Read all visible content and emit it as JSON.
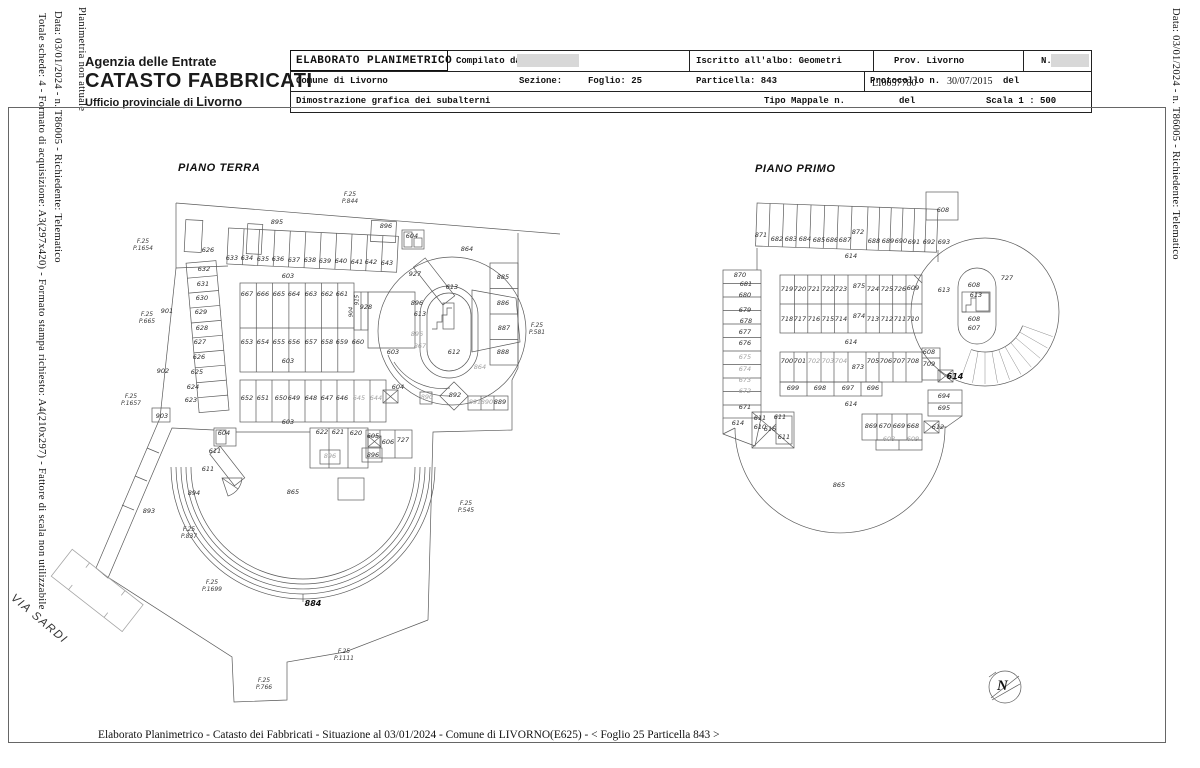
{
  "margins": {
    "left_note_1": "Planimetria non attuale",
    "left_note_2": "Data: 03/01/2024 - n. T86005 - Richiedente: Telematico",
    "left_note_3": "Totale schede: 4 - Formato di acquisizione: A3(297x420) - Formato stampa richiesto: A4(210x297) - Fattore di scala non utilizzabile",
    "right_note": "Data: 03/01/2024 - n. T86005 - Richiedente: Telematico"
  },
  "agency": {
    "line1": "Agenzia delle Entrate",
    "line2": "CATASTO FABBRICATI",
    "line3": "Ufficio provinciale di",
    "city": "Livorno"
  },
  "header_table": {
    "title": "ELABORATO PLANIMETRICO",
    "compilato_label": "Compilato da:",
    "iscritto": "Iscritto all'albo: Geometri",
    "prov": "Prov. Livorno",
    "n_label": "N.",
    "comune": "Comune di Livorno",
    "sezione": "Sezione:",
    "foglio": "Foglio: 25",
    "particella": "Particella: 843",
    "protocollo_label": "Protocollo n.",
    "protocollo_value": "LI0057780",
    "data_presentazione": "30/07/2015",
    "del1": "del",
    "dimostrazione": "Dimostrazione grafica dei subalterni",
    "tipo_mappale": "Tipo Mappale n.",
    "del2": "del",
    "scala": "Scala 1 : 500"
  },
  "street": "VIA SARDI",
  "compass_letter": "N",
  "footer": "Elaborato Planimetrico - Catasto dei Fabbricati - Situazione al 03/01/2024 - Comune di LIVORNO(E625) - < Foglio 25 Particella 843 >",
  "colors": {
    "redacted": "#d8d8d8",
    "linework": "#5a5a5a"
  },
  "plans": {
    "terra": {
      "title": "PIANO TERRA",
      "labels": [
        {
          "t": "895",
          "x": 277,
          "y": 223
        },
        {
          "t": "896",
          "x": 386,
          "y": 227
        },
        {
          "t": "604",
          "x": 412,
          "y": 237
        },
        {
          "t": "864",
          "x": 467,
          "y": 250
        },
        {
          "t": "626",
          "x": 208,
          "y": 251
        },
        {
          "t": "633",
          "x": 232,
          "y": 259
        },
        {
          "t": "634",
          "x": 247,
          "y": 259
        },
        {
          "t": "635",
          "x": 263,
          "y": 260
        },
        {
          "t": "636",
          "x": 278,
          "y": 260
        },
        {
          "t": "637",
          "x": 294,
          "y": 261
        },
        {
          "t": "638",
          "x": 310,
          "y": 261
        },
        {
          "t": "639",
          "x": 325,
          "y": 262
        },
        {
          "t": "640",
          "x": 341,
          "y": 262
        },
        {
          "t": "641",
          "x": 357,
          "y": 263
        },
        {
          "t": "642",
          "x": 371,
          "y": 263
        },
        {
          "t": "643",
          "x": 387,
          "y": 264
        },
        {
          "t": "632",
          "x": 204,
          "y": 270
        },
        {
          "t": "631",
          "x": 203,
          "y": 285
        },
        {
          "t": "630",
          "x": 202,
          "y": 299
        },
        {
          "t": "629",
          "x": 201,
          "y": 313
        },
        {
          "t": "628",
          "x": 202,
          "y": 329
        },
        {
          "t": "627",
          "x": 200,
          "y": 343
        },
        {
          "t": "626",
          "x": 199,
          "y": 358
        },
        {
          "t": "625",
          "x": 197,
          "y": 373
        },
        {
          "t": "624",
          "x": 193,
          "y": 388
        },
        {
          "t": "623",
          "x": 191,
          "y": 401
        },
        {
          "t": "901",
          "x": 167,
          "y": 312
        },
        {
          "t": "902",
          "x": 163,
          "y": 372
        },
        {
          "t": "903",
          "x": 162,
          "y": 417
        },
        {
          "t": "603",
          "x": 288,
          "y": 277
        },
        {
          "t": "603",
          "x": 288,
          "y": 362
        },
        {
          "t": "603",
          "x": 288,
          "y": 423
        },
        {
          "t": "667",
          "x": 247,
          "y": 295
        },
        {
          "t": "666",
          "x": 263,
          "y": 295
        },
        {
          "t": "665",
          "x": 279,
          "y": 295
        },
        {
          "t": "664",
          "x": 294,
          "y": 295
        },
        {
          "t": "663",
          "x": 311,
          "y": 295
        },
        {
          "t": "662",
          "x": 327,
          "y": 295
        },
        {
          "t": "661",
          "x": 342,
          "y": 295
        },
        {
          "t": "915",
          "x": 358,
          "y": 300,
          "s": "r"
        },
        {
          "t": "904",
          "x": 352,
          "y": 312,
          "s": "r"
        },
        {
          "t": "928",
          "x": 366,
          "y": 308
        },
        {
          "t": "653",
          "x": 247,
          "y": 343
        },
        {
          "t": "654",
          "x": 263,
          "y": 343
        },
        {
          "t": "655",
          "x": 279,
          "y": 343
        },
        {
          "t": "656",
          "x": 294,
          "y": 343
        },
        {
          "t": "657",
          "x": 311,
          "y": 343
        },
        {
          "t": "658",
          "x": 327,
          "y": 343
        },
        {
          "t": "659",
          "x": 342,
          "y": 343
        },
        {
          "t": "660",
          "x": 358,
          "y": 343
        },
        {
          "t": "652",
          "x": 247,
          "y": 399
        },
        {
          "t": "651",
          "x": 263,
          "y": 399
        },
        {
          "t": "650",
          "x": 281,
          "y": 399
        },
        {
          "t": "649",
          "x": 294,
          "y": 399
        },
        {
          "t": "648",
          "x": 311,
          "y": 399
        },
        {
          "t": "647",
          "x": 327,
          "y": 399
        },
        {
          "t": "646",
          "x": 342,
          "y": 399
        },
        {
          "t": "645",
          "x": 359,
          "y": 399,
          "s": "g"
        },
        {
          "t": "644",
          "x": 376,
          "y": 399,
          "s": "g"
        },
        {
          "t": "604",
          "x": 398,
          "y": 388
        },
        {
          "t": "890",
          "x": 427,
          "y": 398,
          "s": "g"
        },
        {
          "t": "892",
          "x": 455,
          "y": 396
        },
        {
          "t": "891",
          "x": 475,
          "y": 403,
          "s": "g"
        },
        {
          "t": "890",
          "x": 487,
          "y": 403,
          "s": "g"
        },
        {
          "t": "889",
          "x": 500,
          "y": 403
        },
        {
          "t": "622",
          "x": 322,
          "y": 433
        },
        {
          "t": "621",
          "x": 338,
          "y": 433
        },
        {
          "t": "620",
          "x": 356,
          "y": 434
        },
        {
          "t": "605",
          "x": 373,
          "y": 437
        },
        {
          "t": "606",
          "x": 388,
          "y": 443
        },
        {
          "t": "727",
          "x": 403,
          "y": 441
        },
        {
          "t": "896",
          "x": 330,
          "y": 457,
          "s": "g"
        },
        {
          "t": "896",
          "x": 373,
          "y": 456
        },
        {
          "t": "604",
          "x": 224,
          "y": 434
        },
        {
          "t": "611",
          "x": 215,
          "y": 452
        },
        {
          "t": "611",
          "x": 208,
          "y": 470
        },
        {
          "t": "894",
          "x": 194,
          "y": 494
        },
        {
          "t": "893",
          "x": 149,
          "y": 512
        },
        {
          "t": "927",
          "x": 415,
          "y": 275
        },
        {
          "t": "613",
          "x": 452,
          "y": 288
        },
        {
          "t": "896",
          "x": 417,
          "y": 304
        },
        {
          "t": "613",
          "x": 420,
          "y": 315
        },
        {
          "t": "896",
          "x": 417,
          "y": 335,
          "s": "g"
        },
        {
          "t": "867",
          "x": 420,
          "y": 347,
          "s": "g"
        },
        {
          "t": "603",
          "x": 393,
          "y": 353
        },
        {
          "t": "612",
          "x": 454,
          "y": 353
        },
        {
          "t": "864",
          "x": 480,
          "y": 368,
          "s": "g"
        },
        {
          "t": "885",
          "x": 503,
          "y": 278
        },
        {
          "t": "886",
          "x": 503,
          "y": 304
        },
        {
          "t": "887",
          "x": 504,
          "y": 329
        },
        {
          "t": "888",
          "x": 503,
          "y": 353
        },
        {
          "t": "865",
          "x": 293,
          "y": 493
        },
        {
          "t": "884",
          "x": 313,
          "y": 604,
          "s": "b"
        },
        {
          "t": "F.25\nP.1654",
          "x": 143,
          "y": 245,
          "s": "p"
        },
        {
          "t": "F.25\nP.844",
          "x": 350,
          "y": 198,
          "s": "p"
        },
        {
          "t": "F.25\nP.665",
          "x": 147,
          "y": 318,
          "s": "p"
        },
        {
          "t": "F.25\nP.1657",
          "x": 131,
          "y": 400,
          "s": "p"
        },
        {
          "t": "F.25\nP.581",
          "x": 537,
          "y": 329,
          "s": "p"
        },
        {
          "t": "F.25\nP.545",
          "x": 466,
          "y": 507,
          "s": "p"
        },
        {
          "t": "F.25\nP.837",
          "x": 189,
          "y": 533,
          "s": "p"
        },
        {
          "t": "F.25\nP.1699",
          "x": 212,
          "y": 586,
          "s": "p"
        },
        {
          "t": "F.25\nP.766",
          "x": 264,
          "y": 684,
          "s": "p"
        },
        {
          "t": "F.25\nP.1111",
          "x": 344,
          "y": 655,
          "s": "p"
        }
      ]
    },
    "primo": {
      "title": "PIANO PRIMO",
      "labels": [
        {
          "t": "871",
          "x": 761,
          "y": 236
        },
        {
          "t": "682",
          "x": 777,
          "y": 240
        },
        {
          "t": "683",
          "x": 791,
          "y": 240
        },
        {
          "t": "684",
          "x": 805,
          "y": 240
        },
        {
          "t": "685",
          "x": 819,
          "y": 241
        },
        {
          "t": "686",
          "x": 832,
          "y": 241
        },
        {
          "t": "687",
          "x": 845,
          "y": 241
        },
        {
          "t": "872",
          "x": 858,
          "y": 233
        },
        {
          "t": "688",
          "x": 874,
          "y": 242
        },
        {
          "t": "689",
          "x": 888,
          "y": 242
        },
        {
          "t": "690",
          "x": 901,
          "y": 242
        },
        {
          "t": "691",
          "x": 914,
          "y": 243
        },
        {
          "t": "692",
          "x": 929,
          "y": 243
        },
        {
          "t": "693",
          "x": 944,
          "y": 243
        },
        {
          "t": "608",
          "x": 943,
          "y": 211
        },
        {
          "t": "614",
          "x": 851,
          "y": 257
        },
        {
          "t": "870",
          "x": 740,
          "y": 276
        },
        {
          "t": "681",
          "x": 746,
          "y": 285
        },
        {
          "t": "680",
          "x": 745,
          "y": 296
        },
        {
          "t": "679",
          "x": 745,
          "y": 311
        },
        {
          "t": "678",
          "x": 746,
          "y": 322
        },
        {
          "t": "677",
          "x": 745,
          "y": 333
        },
        {
          "t": "676",
          "x": 745,
          "y": 344
        },
        {
          "t": "675",
          "x": 745,
          "y": 358,
          "s": "g"
        },
        {
          "t": "674",
          "x": 745,
          "y": 370,
          "s": "g"
        },
        {
          "t": "673",
          "x": 745,
          "y": 381,
          "s": "g"
        },
        {
          "t": "672",
          "x": 745,
          "y": 392,
          "s": "g"
        },
        {
          "t": "671",
          "x": 745,
          "y": 408
        },
        {
          "t": "719",
          "x": 787,
          "y": 290
        },
        {
          "t": "720",
          "x": 800,
          "y": 290
        },
        {
          "t": "721",
          "x": 814,
          "y": 290
        },
        {
          "t": "722",
          "x": 828,
          "y": 290
        },
        {
          "t": "723",
          "x": 841,
          "y": 290
        },
        {
          "t": "875",
          "x": 859,
          "y": 287
        },
        {
          "t": "724",
          "x": 873,
          "y": 290
        },
        {
          "t": "725",
          "x": 887,
          "y": 290
        },
        {
          "t": "726",
          "x": 900,
          "y": 290
        },
        {
          "t": "609",
          "x": 913,
          "y": 289
        },
        {
          "t": "718",
          "x": 787,
          "y": 320
        },
        {
          "t": "717",
          "x": 800,
          "y": 320
        },
        {
          "t": "716",
          "x": 814,
          "y": 320
        },
        {
          "t": "715",
          "x": 828,
          "y": 320
        },
        {
          "t": "714",
          "x": 841,
          "y": 320
        },
        {
          "t": "874",
          "x": 859,
          "y": 317
        },
        {
          "t": "713",
          "x": 873,
          "y": 320
        },
        {
          "t": "712",
          "x": 887,
          "y": 320
        },
        {
          "t": "711",
          "x": 900,
          "y": 320
        },
        {
          "t": "710",
          "x": 913,
          "y": 320
        },
        {
          "t": "614",
          "x": 851,
          "y": 343
        },
        {
          "t": "700",
          "x": 787,
          "y": 362
        },
        {
          "t": "701",
          "x": 800,
          "y": 362
        },
        {
          "t": "702",
          "x": 814,
          "y": 362,
          "s": "g"
        },
        {
          "t": "703",
          "x": 828,
          "y": 362,
          "s": "g"
        },
        {
          "t": "704",
          "x": 841,
          "y": 362,
          "s": "g"
        },
        {
          "t": "873",
          "x": 858,
          "y": 368
        },
        {
          "t": "705",
          "x": 873,
          "y": 362
        },
        {
          "t": "706",
          "x": 886,
          "y": 362
        },
        {
          "t": "707",
          "x": 899,
          "y": 362
        },
        {
          "t": "708",
          "x": 913,
          "y": 362
        },
        {
          "t": "699",
          "x": 793,
          "y": 389
        },
        {
          "t": "698",
          "x": 820,
          "y": 389
        },
        {
          "t": "697",
          "x": 848,
          "y": 389
        },
        {
          "t": "696",
          "x": 873,
          "y": 389
        },
        {
          "t": "608",
          "x": 929,
          "y": 353
        },
        {
          "t": "709",
          "x": 929,
          "y": 365
        },
        {
          "t": "614",
          "x": 955,
          "y": 377,
          "s": "b"
        },
        {
          "t": "694",
          "x": 944,
          "y": 397
        },
        {
          "t": "695",
          "x": 944,
          "y": 409
        },
        {
          "t": "614",
          "x": 851,
          "y": 405
        },
        {
          "t": "614",
          "x": 738,
          "y": 424
        },
        {
          "t": "611",
          "x": 760,
          "y": 419
        },
        {
          "t": "611",
          "x": 780,
          "y": 418
        },
        {
          "t": "610",
          "x": 760,
          "y": 428
        },
        {
          "t": "616",
          "x": 770,
          "y": 430
        },
        {
          "t": "611",
          "x": 784,
          "y": 438
        },
        {
          "t": "869",
          "x": 871,
          "y": 427
        },
        {
          "t": "670",
          "x": 885,
          "y": 427
        },
        {
          "t": "669",
          "x": 899,
          "y": 427
        },
        {
          "t": "668",
          "x": 913,
          "y": 427
        },
        {
          "t": "608",
          "x": 889,
          "y": 440,
          "s": "g"
        },
        {
          "t": "609",
          "x": 913,
          "y": 440,
          "s": "g"
        },
        {
          "t": "612",
          "x": 938,
          "y": 428
        },
        {
          "t": "613",
          "x": 944,
          "y": 291
        },
        {
          "t": "727",
          "x": 1007,
          "y": 279
        },
        {
          "t": "608",
          "x": 974,
          "y": 286
        },
        {
          "t": "613",
          "x": 976,
          "y": 296
        },
        {
          "t": "608",
          "x": 974,
          "y": 320
        },
        {
          "t": "607",
          "x": 974,
          "y": 329
        },
        {
          "t": "865",
          "x": 839,
          "y": 486
        }
      ]
    }
  }
}
